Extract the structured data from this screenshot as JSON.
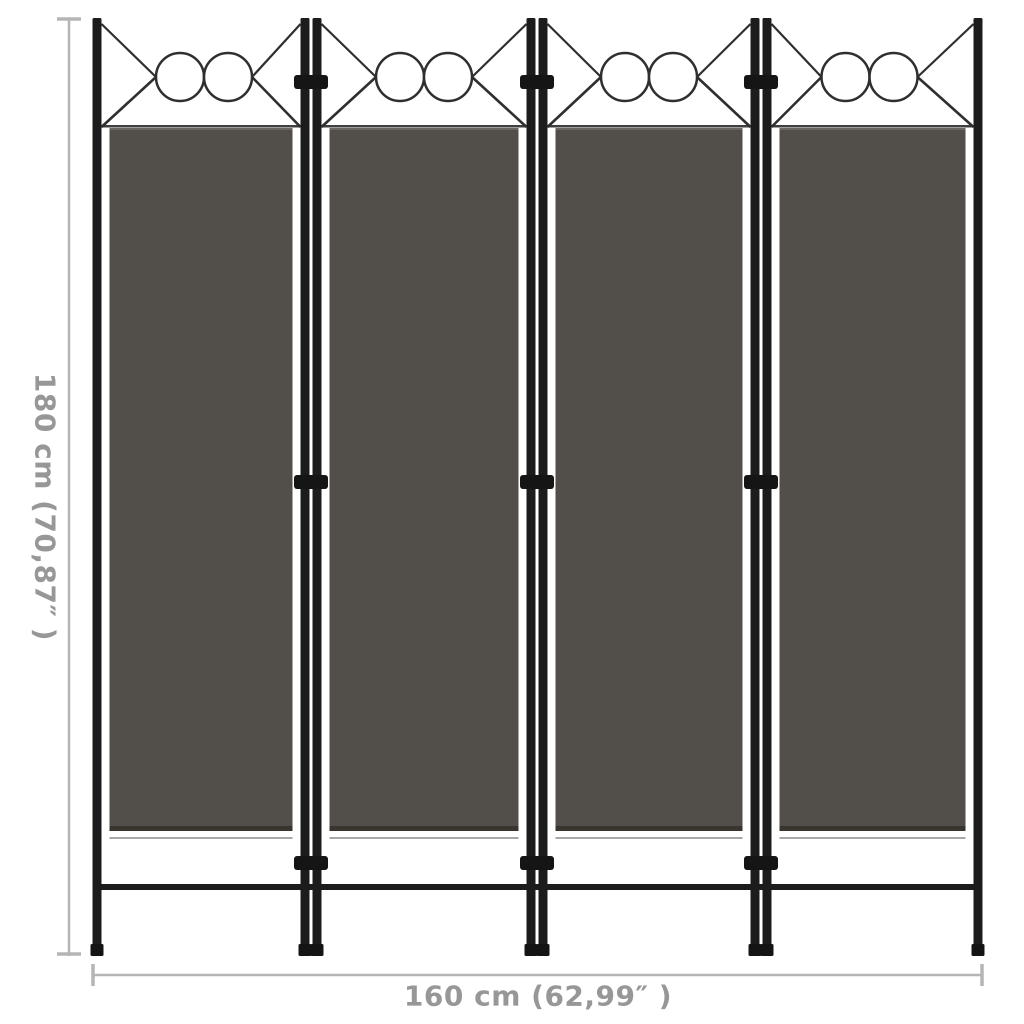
{
  "page": {
    "background_color": "#ffffff",
    "description": "Product dimension image of a 4-panel anthracite room divider"
  },
  "dimensions": {
    "height_label": "180 cm (70,87″ )",
    "width_label": "160 cm (62,99″ )",
    "line_color": "#b5b5b5",
    "text_color": "#979797"
  },
  "divider": {
    "panel_count": 4,
    "circles_per_panel": 2,
    "fabric_color": "#524e4a",
    "fabric_top_edge_color": "#6b6661",
    "fabric_bottom_edge_color": "#38342e",
    "hem_shadow_color": "#a8a8a8",
    "frame_color": "#1c1c1c",
    "connector_color": "#151515",
    "foot_color": "#141414",
    "top_tube_color": "#3f3f3f",
    "decoration_line_color": "#2f2f2f",
    "circle_fill_color": "#ffffff"
  }
}
